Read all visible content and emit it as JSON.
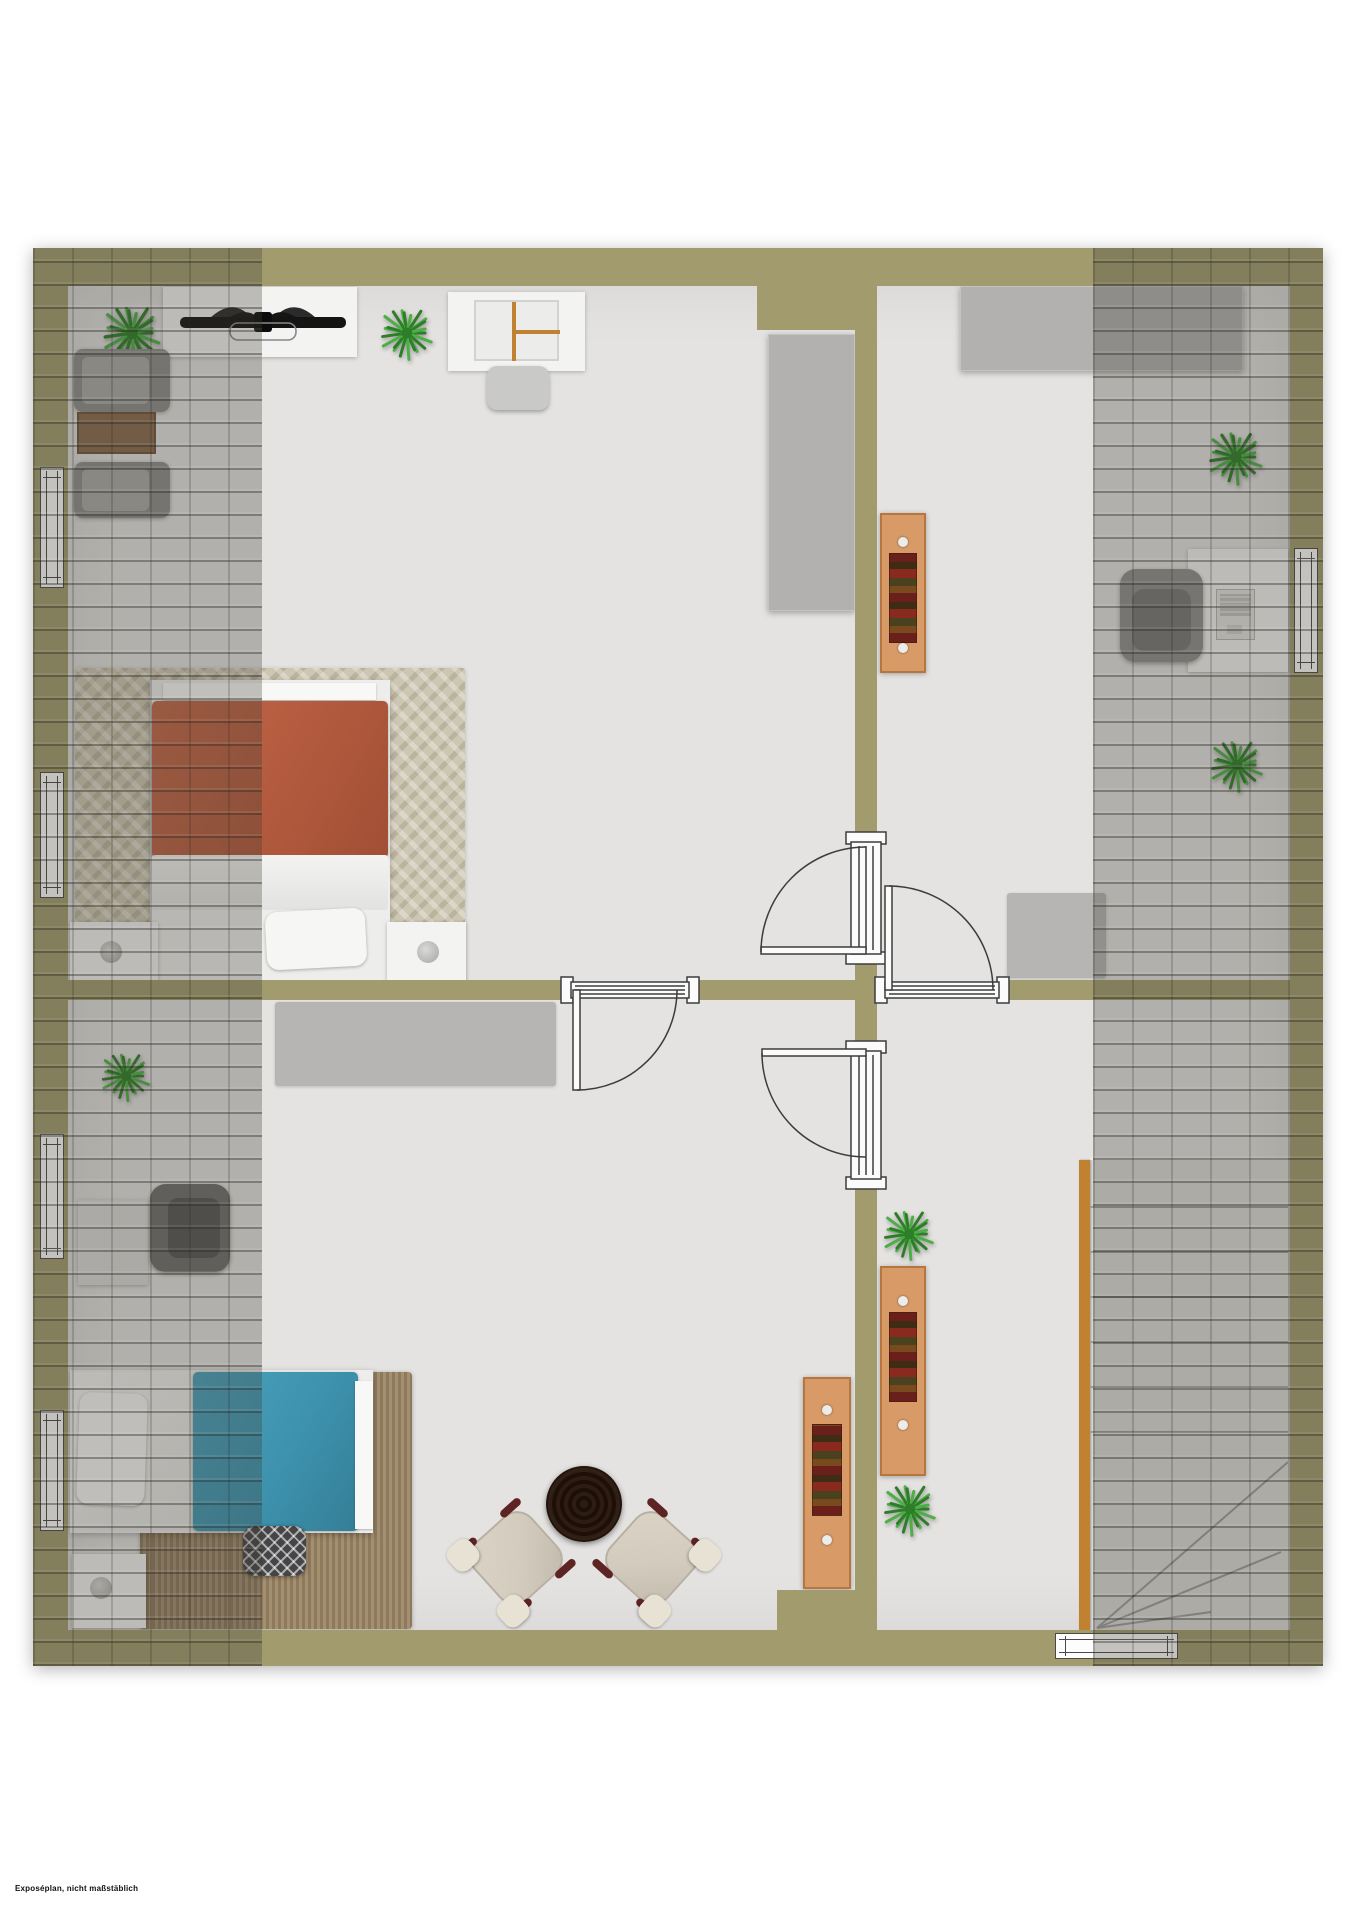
{
  "page": {
    "background": "#ffffff",
    "disclaimer": "Exposéplan, nicht maßstäblich"
  },
  "colors": {
    "page-bg": "#ffffff",
    "wall": "#a19b6d",
    "floor": "#e4e3e1",
    "floor-shade": "#dcdbd9",
    "roof-tint": "rgba(62,60,50,0.30)",
    "tile-line": "rgba(40,38,32,0.38)",
    "tile-line-soft": "rgba(40,38,32,0.20)",
    "white-furniture": "#f3f3f1",
    "wardrobe-gray": "#b2b1af",
    "rug-gray": "#b6b5b3",
    "rug-knit": "#cdc6b2",
    "rug-shag": "#9d8766",
    "bed-red": "#b35a3e",
    "bed-blue": "#3e92ae",
    "wood": "#d89a66",
    "wood-dark": "#b5773f",
    "stair-wood": "#c08130",
    "plant-dark": "#2e7d28",
    "plant-light": "#4caf46",
    "chair-gray": "#8f8f8d",
    "chair-dark": "#6f6f6d",
    "armchair-beige": "#d3ccbe",
    "armchair-trim": "#5d2423",
    "table-dark": "#2a1a12",
    "pouf-dark": "#454547",
    "door-line": "#3c3c3c"
  },
  "plan": {
    "type": "residential floor plan, top-down 3D render, attic storey with sloped-roof overlays",
    "rooms": [
      {
        "id": "bedroom-top-left",
        "furniture": [
          "sideboard",
          "ceiling-fan",
          "plant",
          "plant",
          "desk-with-chair",
          "wardrobe",
          "wicker-chair",
          "side-table",
          "wicker-chair",
          "knit-rug",
          "double-bed-red",
          "nightstand-with-lamp",
          "nightstand-with-lamp"
        ]
      },
      {
        "id": "room-top-right",
        "furniture": [
          "wardrobe",
          "bookcase",
          "rug",
          "desk-with-laptop",
          "armchair-gray",
          "plant",
          "plant"
        ]
      },
      {
        "id": "bedroom-bottom-left",
        "furniture": [
          "rug",
          "plant",
          "desk",
          "armchair-dark",
          "shag-rug",
          "single-bed-blue",
          "pouf",
          "nightstand-with-lamp",
          "bookcase",
          "round-coffee-table",
          "lounge-chair",
          "lounge-chair"
        ]
      },
      {
        "id": "hallway-with-stairs",
        "furniture": [
          "plant",
          "bookcase",
          "plant",
          "winder-staircase"
        ]
      }
    ],
    "door_count": 4,
    "window_count": 6,
    "roof_slope_overlays": [
      "left-strip",
      "right-strip"
    ]
  }
}
